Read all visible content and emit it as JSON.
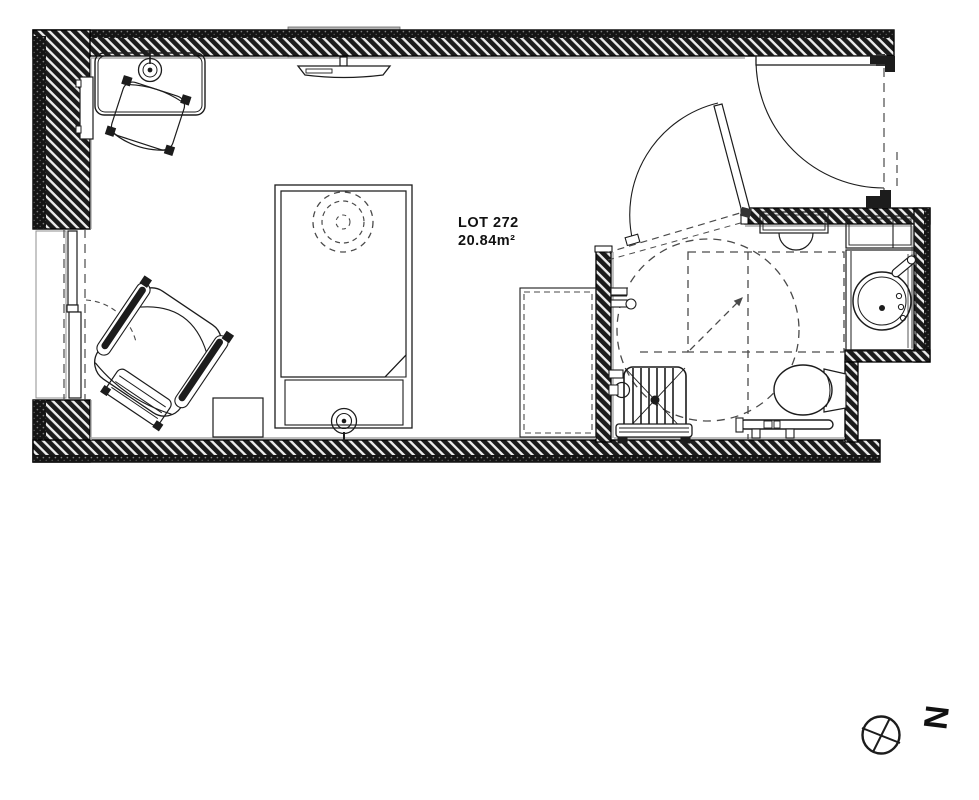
{
  "drawing": {
    "type": "architectural-floor-plan",
    "lot_label": "LOT 272",
    "area_label": "20.84m²",
    "compass_letter": "N"
  },
  "colors": {
    "line": "#1c1c1c",
    "wall_fill": "#181818",
    "wall_slash": "#f5f5f5",
    "accent_gray": "#b5b5b5",
    "dash_gray": "#4a4a4a",
    "paper": "#ffffff"
  },
  "rooms": [
    {
      "name": "bedroom",
      "fixtures": [
        "desk",
        "desk-lamp",
        "desk-chair",
        "radiator-panel",
        "wall-tv",
        "single-bed",
        "ceiling-light-dashed",
        "nightstand",
        "armchair",
        "ottoman",
        "window",
        "wardrobe-dashed"
      ]
    },
    {
      "name": "bathroom",
      "fixtures": [
        "shower-seat",
        "shower-bench",
        "shower-valves",
        "toilet",
        "grab-bar",
        "round-washbasin",
        "vanity-counter",
        "vanity-shelf",
        "hand-shelf",
        "accessibility-turning-circle",
        "transfer-zone-dashed"
      ]
    },
    {
      "name": "entry",
      "fixtures": [
        "entrance-door",
        "bathroom-door",
        "door-frame-stops"
      ]
    }
  ],
  "annotations": [
    "north-compass"
  ]
}
